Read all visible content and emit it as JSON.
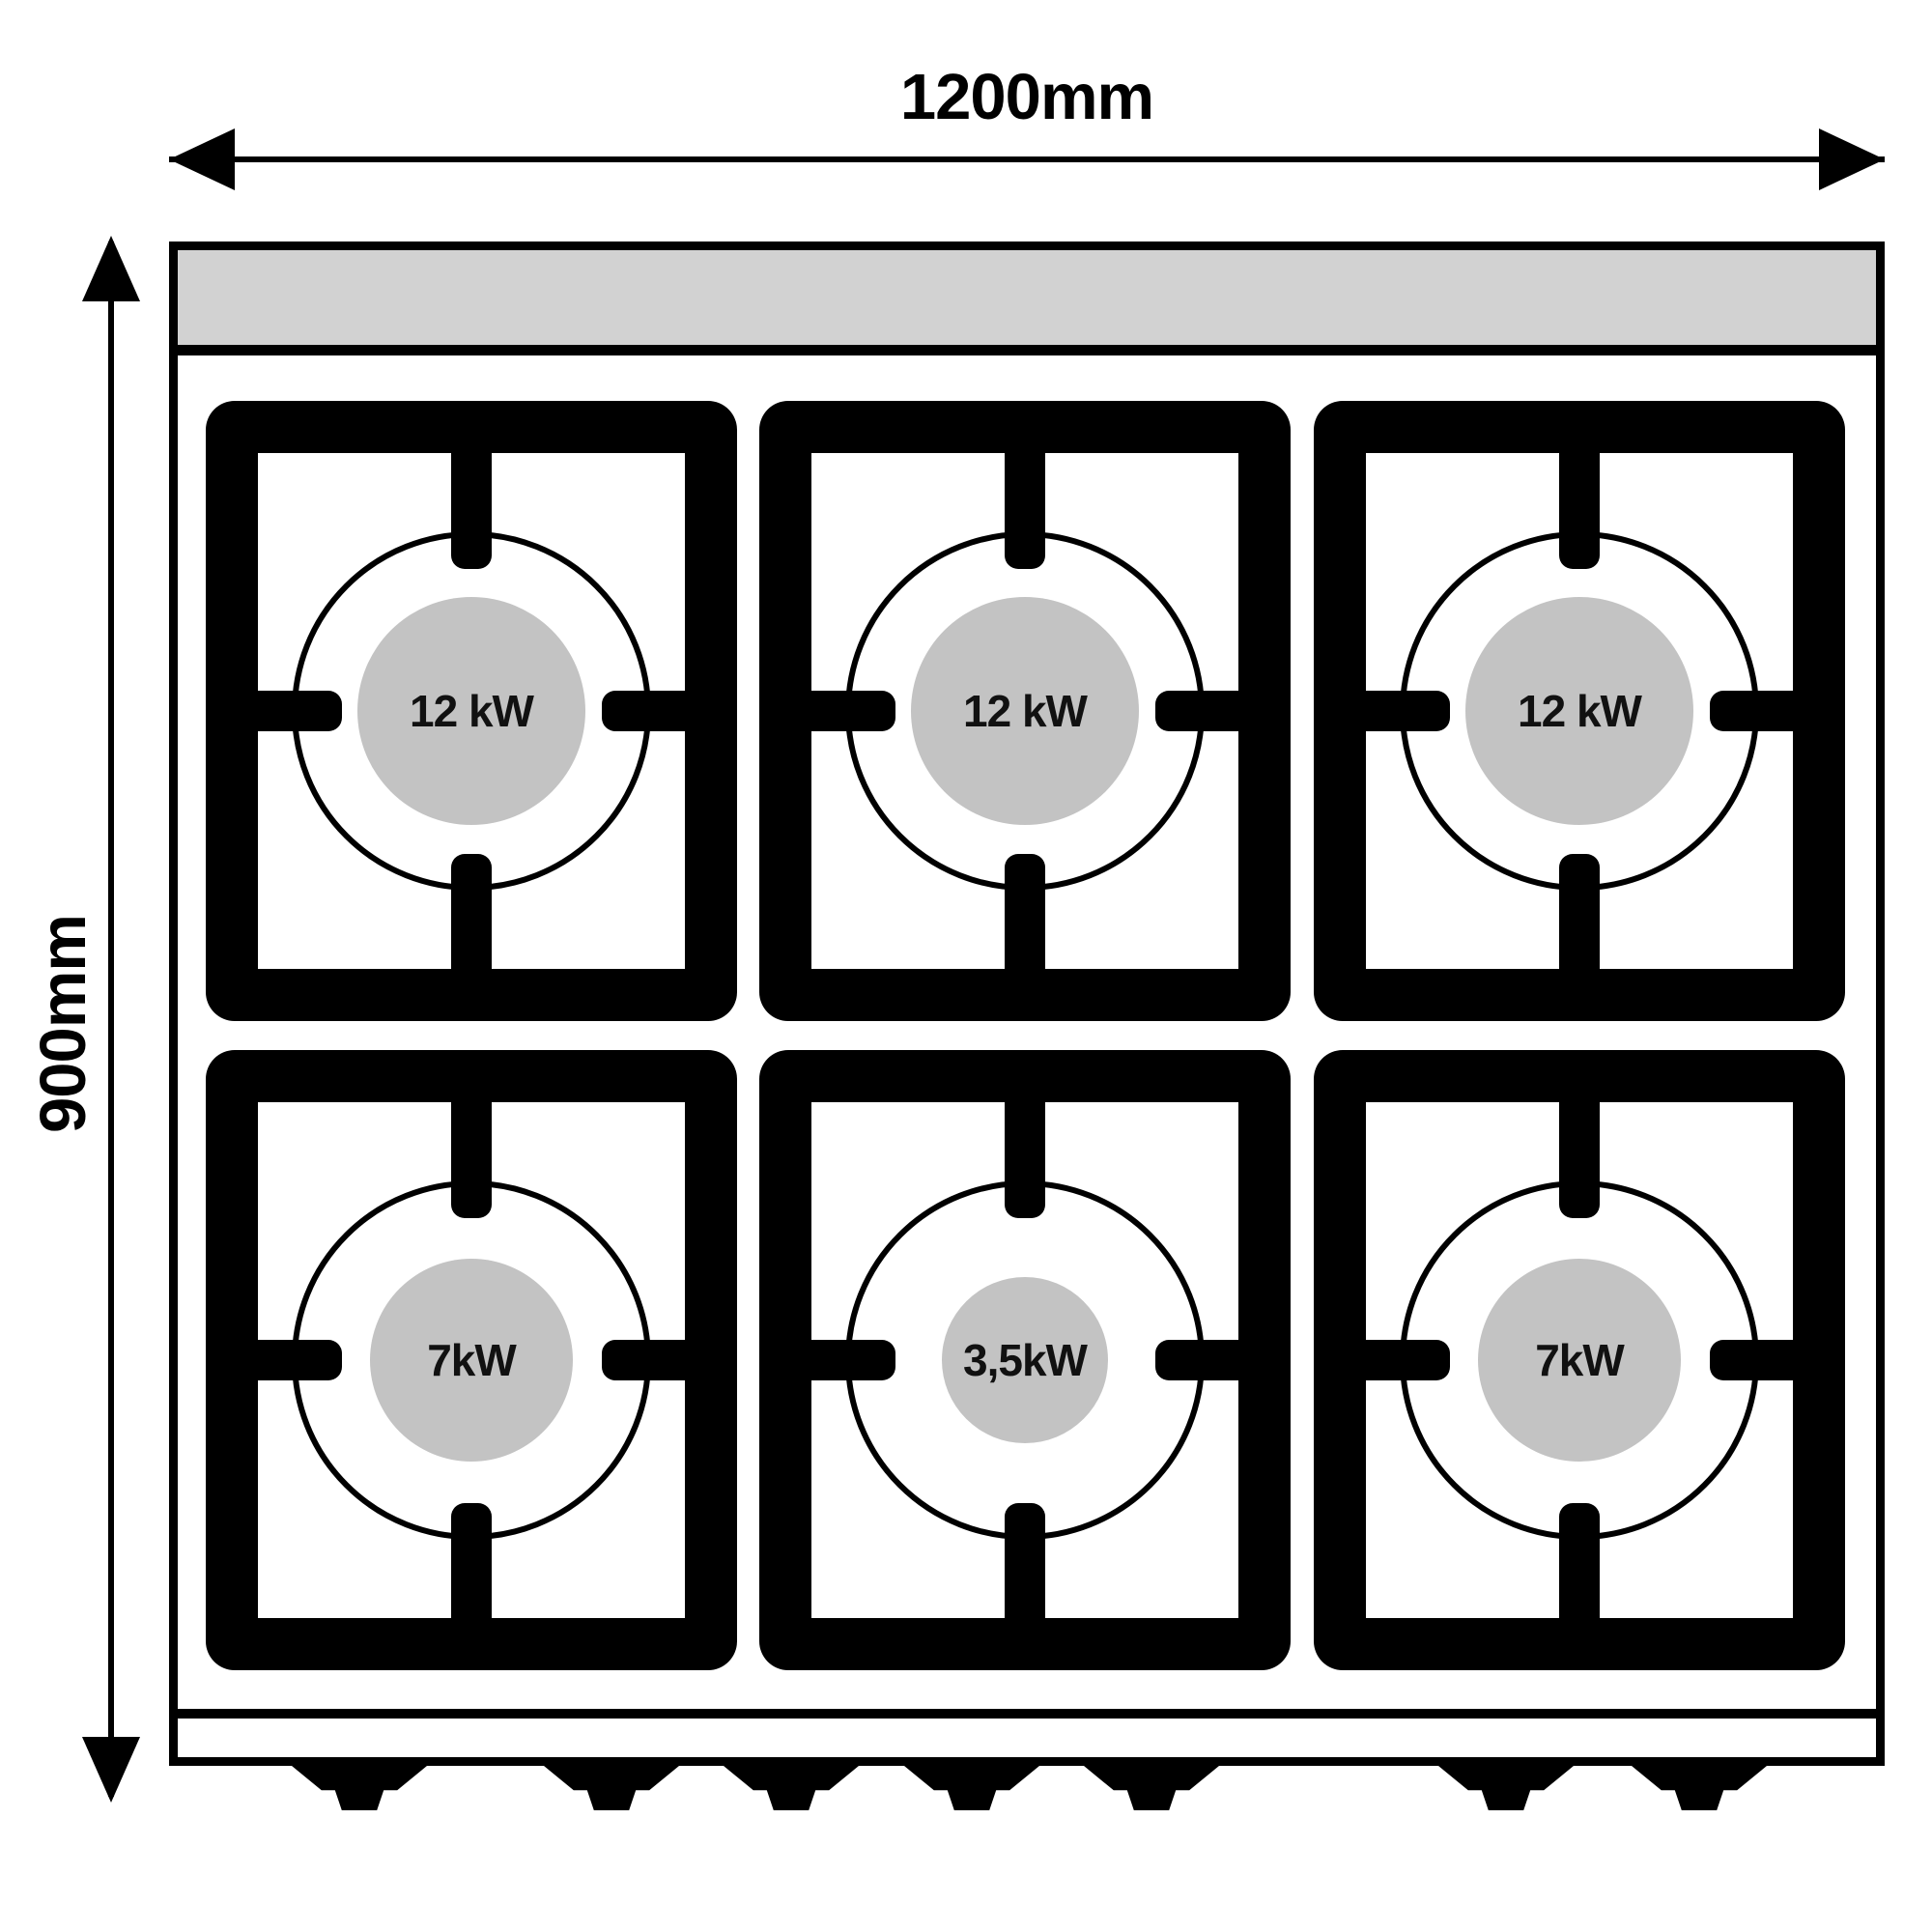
{
  "dimensions": {
    "width_label": "1200mm",
    "depth_label": "900mm"
  },
  "stove": {
    "type": "gas-range-top-view",
    "burner_rows": 2,
    "burner_columns": 3,
    "feet_count": 7,
    "burners": [
      {
        "position": "top-left",
        "power_label": "12 kW",
        "size": "large"
      },
      {
        "position": "top-center",
        "power_label": "12 kW",
        "size": "large"
      },
      {
        "position": "top-right",
        "power_label": "12 kW",
        "size": "large"
      },
      {
        "position": "bottom-left",
        "power_label": "7kW",
        "size": "medium"
      },
      {
        "position": "bottom-center",
        "power_label": "3,5kW",
        "size": "small"
      },
      {
        "position": "bottom-right",
        "power_label": "7kW",
        "size": "medium"
      }
    ]
  },
  "colors": {
    "outline": "#000000",
    "panel_gray": "#d2d2d2",
    "burner_gray": "#c3c3c3",
    "background": "#ffffff"
  }
}
